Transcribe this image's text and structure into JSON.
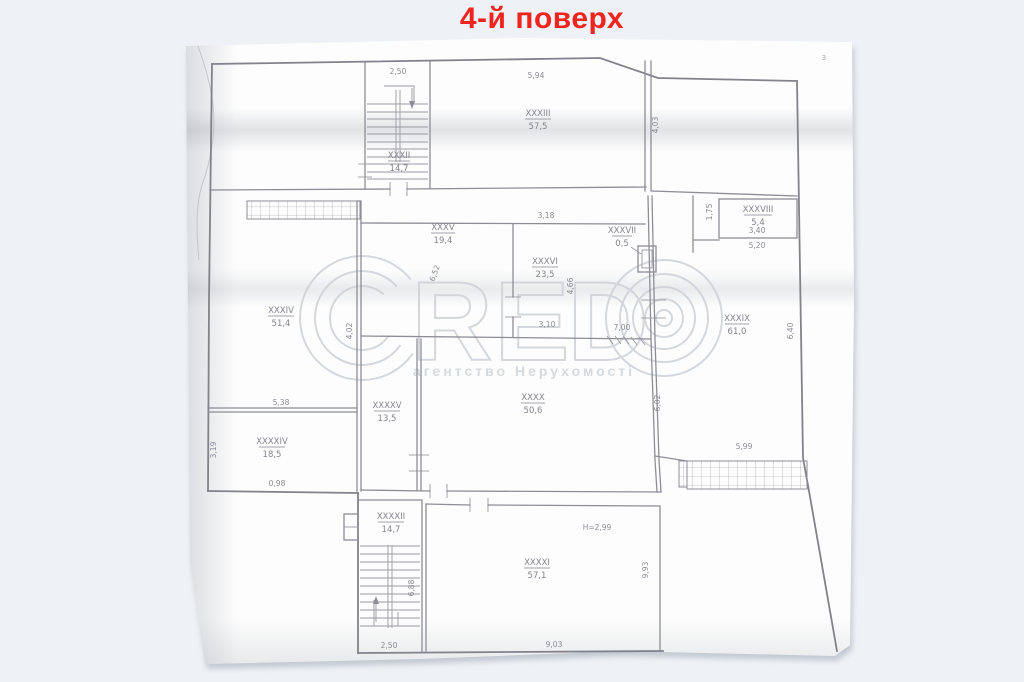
{
  "page": {
    "title": "4-й поверх",
    "title_color": "#ee241e",
    "background_color": "#eef2f6",
    "paper_color": "#fdfdfd",
    "corner_mark": "3"
  },
  "watermark": {
    "brand": "CRED©",
    "letters": [
      "R",
      "E",
      "D"
    ],
    "subtitle": "агентство Нерухомості",
    "color": "#cdd2d8"
  },
  "plan": {
    "line_color": "#8d8d97",
    "text_color": "#8a8a94",
    "rooms": [
      {
        "number": "XXXII",
        "area": "14,7"
      },
      {
        "number": "XXXIII",
        "area": "57,5"
      },
      {
        "number": "XXXIV",
        "area": "51,4"
      },
      {
        "number": "XXXV",
        "area": "19,4"
      },
      {
        "number": "XXXVI",
        "area": "23,5"
      },
      {
        "number": "XXXVII",
        "area": "0,5"
      },
      {
        "number": "XXXVIII",
        "area": "5,4"
      },
      {
        "number": "XXXIX",
        "area": "61,0"
      },
      {
        "number": "XXXX",
        "area": "50,6"
      },
      {
        "number": "XXXXV",
        "area": "13,5"
      },
      {
        "number": "XXXXIV",
        "area": "18,5"
      },
      {
        "number": "XXXXII",
        "area": "14,7"
      },
      {
        "number": "XXXXI",
        "area": "57,1"
      }
    ],
    "dimensions": [
      {
        "value": "2,50"
      },
      {
        "value": "5,94"
      },
      {
        "value": "4,03"
      },
      {
        "value": "3,18"
      },
      {
        "value": "6,52"
      },
      {
        "value": "4,66"
      },
      {
        "value": "3,10"
      },
      {
        "value": "7,00"
      },
      {
        "value": "1,75"
      },
      {
        "value": "3,40"
      },
      {
        "value": "5,20"
      },
      {
        "value": "6,40"
      },
      {
        "value": "6,02"
      },
      {
        "value": "4,02"
      },
      {
        "value": "5,38"
      },
      {
        "value": "3,19"
      },
      {
        "value": "0,98"
      },
      {
        "value": "5,99"
      },
      {
        "value": "6,88"
      },
      {
        "value": "2,50"
      },
      {
        "value": "Н=2,99"
      },
      {
        "value": "9,93"
      },
      {
        "value": "9,03"
      }
    ]
  }
}
